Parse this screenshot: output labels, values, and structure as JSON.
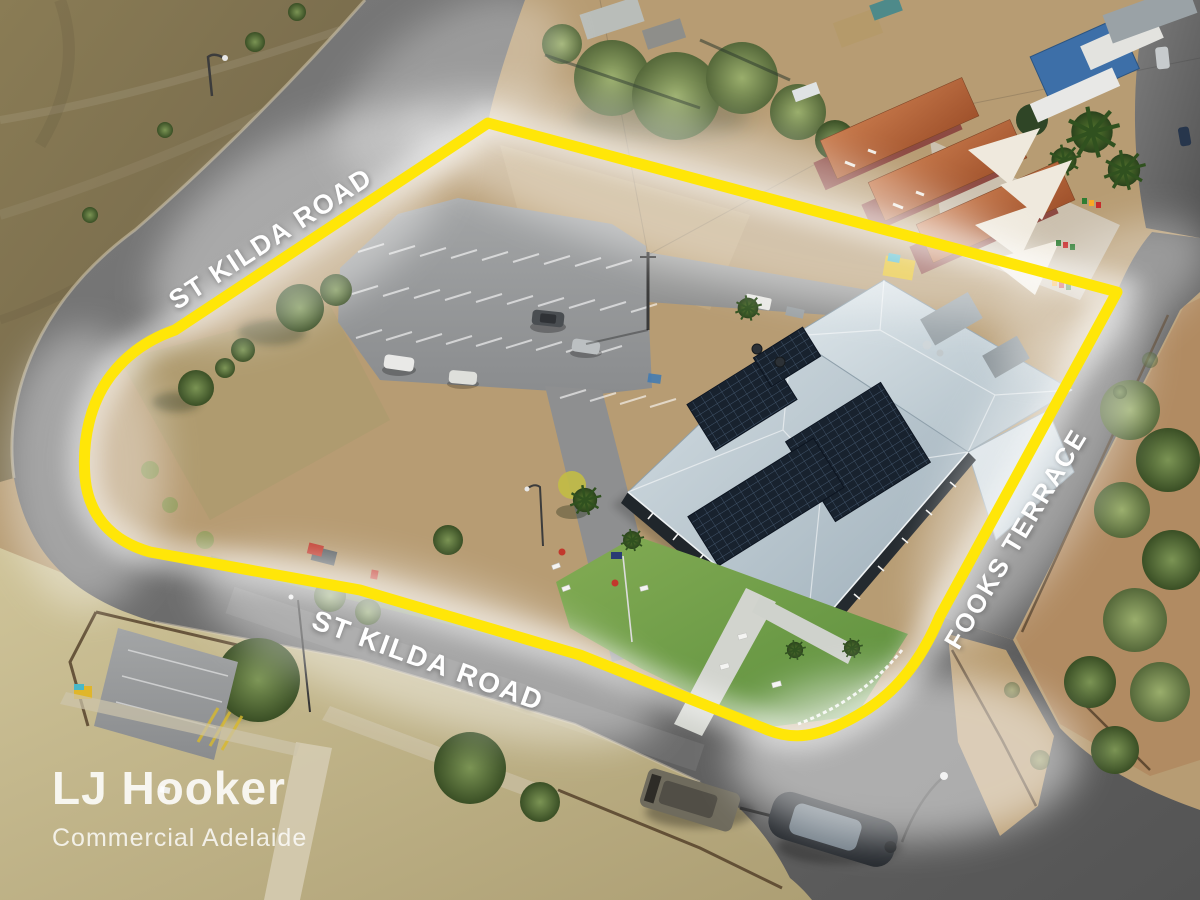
{
  "brand_watermark": {
    "name": "LJ Hooker",
    "division": "Commercial Adelaide"
  },
  "road_labels": {
    "top": "ST KILDA ROAD",
    "bottom": "ST KILDA ROAD",
    "right": "FOOKS TERRACE"
  },
  "boundary": {
    "color": "#ffe608"
  },
  "palette": {
    "boundary_yellow": "#ffe608",
    "road_asphalt": "#6e6e6e",
    "hotel_roof_grey": "#bcc9d0",
    "solar_panel": "#18222e",
    "field_olive": "#847550",
    "lawn_green": "#76a247",
    "dry_grass": "#c6ba8c",
    "dirt_tan": "#b79c73",
    "terracotta_roof": "#b5643f",
    "shade_sail_white": "#efe9dd"
  }
}
